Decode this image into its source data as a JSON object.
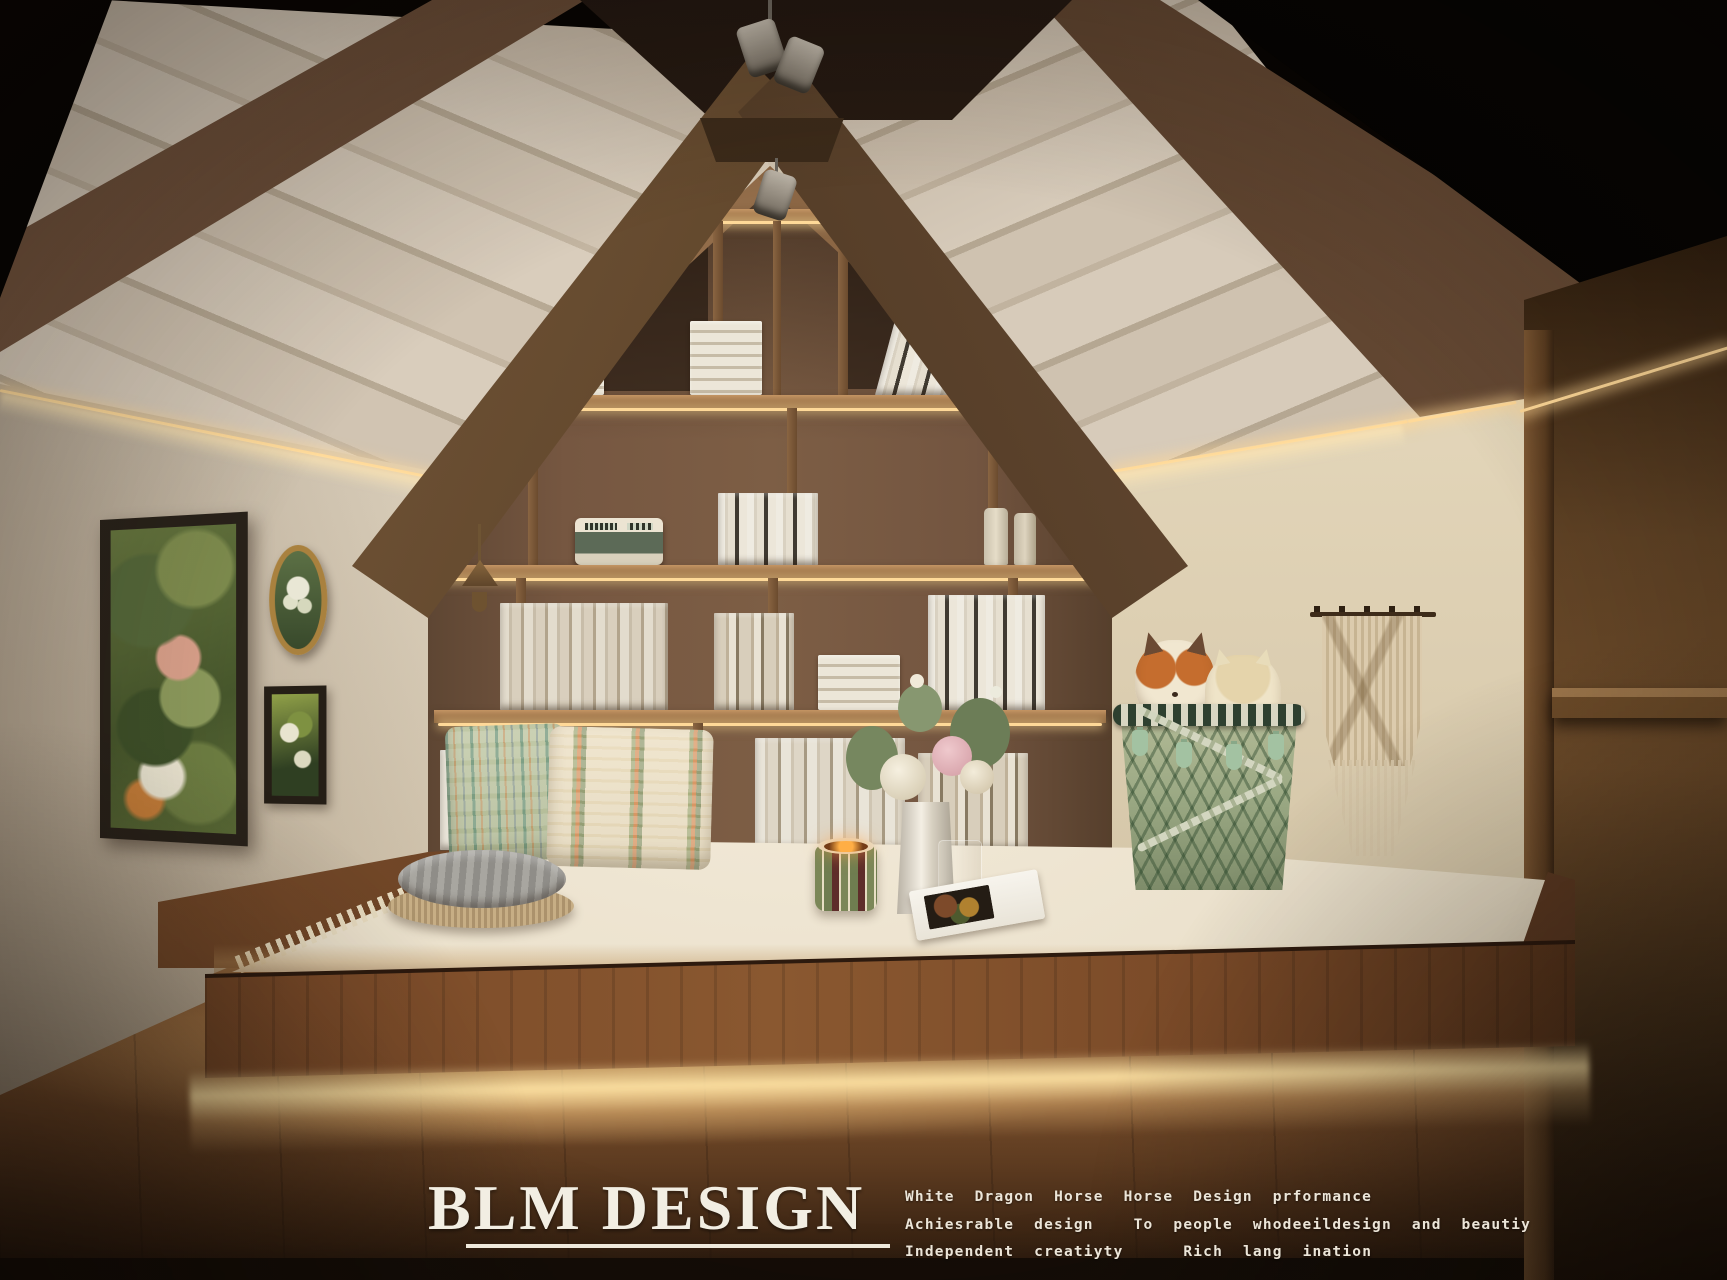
{
  "watermark": {
    "title": "BLM DESIGN",
    "tagline_lines": [
      "White Dragon Horse Horse Design prformance",
      "Achiesrable design  To people whodeeildesign and beautiy",
      "Independent creatiyty   Rich lang ination"
    ]
  },
  "palette": {
    "void": "#070402",
    "roof_plank": "#d6c9b7",
    "roof_shadow": "#b9aa94",
    "beam": "#5d4429",
    "beam_dark": "#3c2b19",
    "ridge": "#382817",
    "shelf_wall": "#7a5b42",
    "shelf_wall_dark": "#473424",
    "shelf_wood": "#a57a4e",
    "book_cream": "#e0d8c8",
    "book_dark": "#3f382f",
    "led": "#ffd998",
    "wall": "#e7dcc8",
    "wall_shade": "#c8b89e",
    "platform": "#7b4a28",
    "platform_dark": "#4f2f18",
    "floor": "#7d5230",
    "floor_glow": "#e8b877",
    "floor_dark": "#241710",
    "rug": "#eee4d0",
    "rug_shade": "#d6c7aa",
    "pillow_green": "#bcc5a5",
    "pillow_cream": "#eadfc4",
    "accent_orange": "#cf7038",
    "accent_green": "#6d8a5a",
    "basket": "#9aa883",
    "tassel": "#a3c2a2",
    "plush_orange": "#c2672f",
    "plush_cream": "#f0e6cf",
    "macrame": "#d7c6a8",
    "cabinet": "#5d3f24",
    "frame_dark": "#282119",
    "frame_gold": "#a9813e",
    "art_green": "#5a6b39",
    "text": "#f2eee3"
  }
}
